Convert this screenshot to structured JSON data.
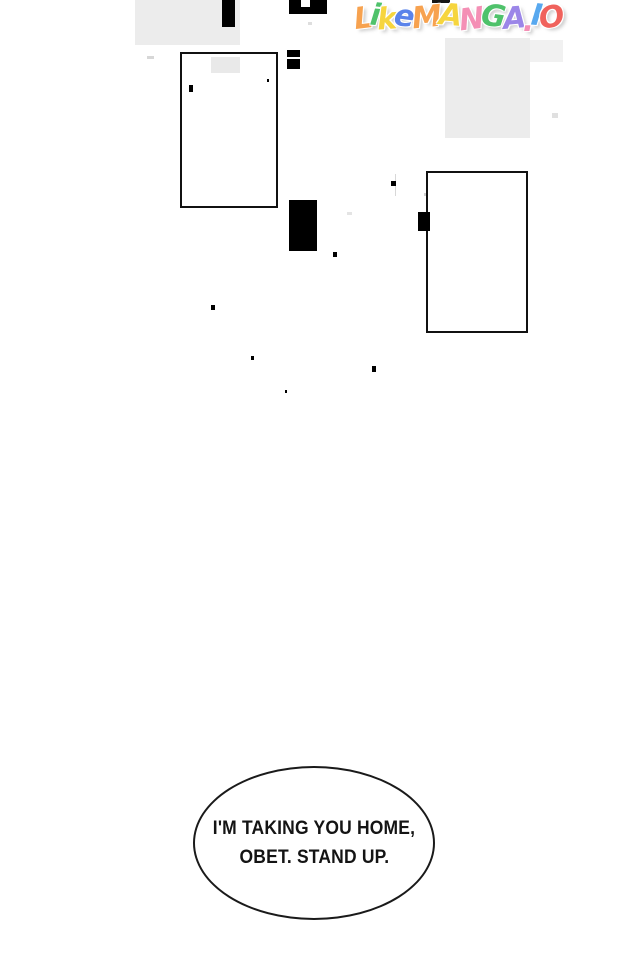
{
  "site": {
    "name": "LikeManga.io"
  },
  "watermark": {
    "letters": [
      {
        "ch": "L",
        "color": "#f7a24f"
      },
      {
        "ch": "i",
        "color": "#4fc26b"
      },
      {
        "ch": "k",
        "color": "#f6d53e"
      },
      {
        "ch": "e",
        "color": "#5a83ea"
      },
      {
        "ch": "M",
        "color": "#f7a24f"
      },
      {
        "ch": "A",
        "color": "#f6d53e"
      },
      {
        "ch": "N",
        "color": "#f48fb5"
      },
      {
        "ch": "G",
        "color": "#4fc26b"
      },
      {
        "ch": "A",
        "color": "#9b86e8"
      },
      {
        "ch": ".",
        "color": "#f48fb5"
      },
      {
        "ch": "I",
        "color": "#58a8ef"
      },
      {
        "ch": "O",
        "color": "#f0625c"
      }
    ]
  },
  "speech_bubble": {
    "line1": "I'M TAKING YOU HOME,",
    "line2": "OBET. STAND UP."
  },
  "colors": {
    "ink": "#000000",
    "panel_border": "#111111",
    "shade": "#ececec"
  }
}
